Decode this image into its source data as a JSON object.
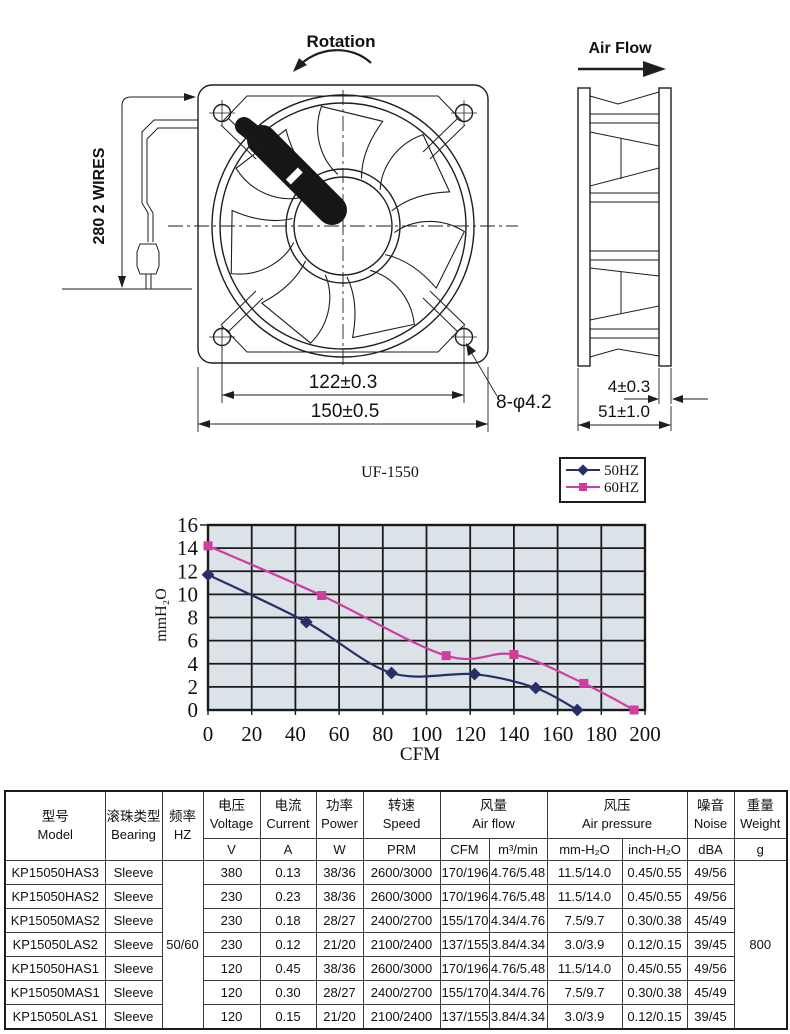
{
  "drawing": {
    "rotation_label": "Rotation",
    "airflow_label": "Air Flow",
    "wires_label": "280  2 WIRES",
    "dim_hole_pitch": "122±0.3",
    "dim_frame": "150±0.5",
    "dim_holes": "8-φ4.2",
    "dim_thickness": "4±0.3",
    "dim_depth": "51±1.0"
  },
  "chart_data": {
    "type": "line",
    "title": "UF-1550",
    "xlabel": "CFM",
    "ylabel": "mmH₂O",
    "xlim": [
      0,
      200
    ],
    "xstep": 20,
    "ylim": [
      0,
      16
    ],
    "ystep": 2,
    "grid": true,
    "plot_bg": "#dbe2e8",
    "grid_color": "#1a1a1a",
    "legend_position": "top-right",
    "series": [
      {
        "name": "50HZ",
        "color": "#272f68",
        "marker": "diamond",
        "points": [
          [
            0,
            11.7
          ],
          [
            45,
            7.6
          ],
          [
            84,
            3.2
          ],
          [
            122,
            3.1
          ],
          [
            150,
            1.9
          ],
          [
            169,
            0
          ]
        ]
      },
      {
        "name": "60HZ",
        "color": "#cf3da0",
        "marker": "square",
        "points": [
          [
            0,
            14.2
          ],
          [
            52,
            9.9
          ],
          [
            109,
            4.7
          ],
          [
            140,
            4.8
          ],
          [
            172,
            2.3
          ],
          [
            195,
            0
          ]
        ]
      }
    ]
  },
  "table": {
    "header": {
      "model_zh": "型号",
      "model_en": "Model",
      "bearing_zh": "滚珠类型",
      "bearing_en": "Bearing",
      "freq_zh": "频率",
      "freq_en": "HZ",
      "voltage_zh": "电压",
      "voltage_en": "Voltage",
      "voltage_unit": "V",
      "current_zh": "电流",
      "current_en": "Current",
      "current_unit": "A",
      "power_zh": "功率",
      "power_en": "Power",
      "power_unit": "W",
      "speed_zh": "转速",
      "speed_en": "Speed",
      "speed_unit": "PRM",
      "airflow_zh": "风量",
      "airflow_en": "Air flow",
      "airflow_unit_cfm": "CFM",
      "airflow_unit_m3": "m³/min",
      "pressure_zh": "风压",
      "pressure_en": "Air pressure",
      "pressure_unit_mm": "mm-H₂O",
      "pressure_unit_inch": "inch-H₂O",
      "noise_zh": "噪音",
      "noise_en": "Noise",
      "noise_unit": "dBA",
      "weight_zh": "重量",
      "weight_en": "Weight",
      "weight_unit": "g"
    },
    "freq_value": "50/60",
    "weight_value": "800",
    "rows": [
      [
        "KP15050HAS3",
        "Sleeve",
        "380",
        "0.13",
        "38/36",
        "2600/3000",
        "170/196",
        "4.76/5.48",
        "11.5/14.0",
        "0.45/0.55",
        "49/56"
      ],
      [
        "KP15050HAS2",
        "Sleeve",
        "230",
        "0.23",
        "38/36",
        "2600/3000",
        "170/196",
        "4.76/5.48",
        "11.5/14.0",
        "0.45/0.55",
        "49/56"
      ],
      [
        "KP15050MAS2",
        "Sleeve",
        "230",
        "0.18",
        "28/27",
        "2400/2700",
        "155/170",
        "4.34/4.76",
        "7.5/9.7",
        "0.30/0.38",
        "45/49"
      ],
      [
        "KP15050LAS2",
        "Sleeve",
        "230",
        "0.12",
        "21/20",
        "2100/2400",
        "137/155",
        "3.84/4.34",
        "3.0/3.9",
        "0.12/0.15",
        "39/45"
      ],
      [
        "KP15050HAS1",
        "Sleeve",
        "120",
        "0.45",
        "38/36",
        "2600/3000",
        "170/196",
        "4.76/5.48",
        "11.5/14.0",
        "0.45/0.55",
        "49/56"
      ],
      [
        "KP15050MAS1",
        "Sleeve",
        "120",
        "0.30",
        "28/27",
        "2400/2700",
        "155/170",
        "4.34/4.76",
        "7.5/9.7",
        "0.30/0.38",
        "45/49"
      ],
      [
        "KP15050LAS1",
        "Sleeve",
        "120",
        "0.15",
        "21/20",
        "2100/2400",
        "137/155",
        "3.84/4.34",
        "3.0/3.9",
        "0.12/0.15",
        "39/45"
      ]
    ]
  }
}
